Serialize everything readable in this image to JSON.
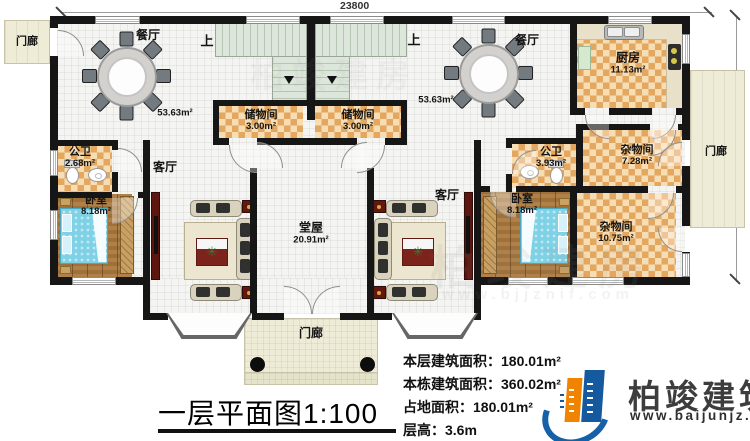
{
  "dimensions": {
    "top": "23800",
    "right": "12300"
  },
  "rooms": {
    "porch_top_left": {
      "label": "门廊"
    },
    "porch_right": {
      "label": "门廊"
    },
    "porch_bottom": {
      "label": "门廊"
    },
    "dining_left": {
      "label": "餐厅",
      "area": "53.63m²"
    },
    "dining_right": {
      "label": "餐厅",
      "area": "53.63m²"
    },
    "stairs_left": {
      "label": "上"
    },
    "stairs_right": {
      "label": "上"
    },
    "storage_left": {
      "label": "储物间",
      "area": "3.00m²"
    },
    "storage_right": {
      "label": "储物间",
      "area": "3.00m²"
    },
    "kitchen": {
      "label": "厨房",
      "area": "11.13m²"
    },
    "bath_left": {
      "label": "公卫",
      "area": "2.68m²"
    },
    "bath_right": {
      "label": "公卫",
      "area": "3.93m²"
    },
    "bedroom_left": {
      "label": "卧室",
      "area": "8.18m²"
    },
    "bedroom_right": {
      "label": "卧室",
      "area": "8.18m²"
    },
    "living_left": {
      "label": "客厅"
    },
    "living_right": {
      "label": "客厅"
    },
    "hall": {
      "label": "堂屋",
      "area": "20.91m²"
    },
    "utility_upper": {
      "label": "杂物间",
      "area": "7.28m²"
    },
    "utility_lower": {
      "label": "杂物间",
      "area": "10.75m²"
    }
  },
  "title": {
    "text": "一层平面图1:100"
  },
  "stats": {
    "lines": [
      {
        "label": "本层建筑面积：",
        "value": "180.01m²"
      },
      {
        "label": "本栋建筑面积：",
        "value": "360.02m²"
      },
      {
        "label": "占地面积：",
        "value": "180.01m²"
      },
      {
        "label": "层高：",
        "value": "3.6m"
      }
    ]
  },
  "logo": {
    "name": "柏竣建筑",
    "site": "www.baijunjz.com"
  },
  "watermark": {
    "text": "柏竣建房",
    "site": "www.bjjznif.com"
  },
  "colors": {
    "wall": "#161616",
    "checker": "#e3a75f",
    "wood": "#a9773b",
    "bed": "#7fd2e6",
    "porch": "#eeebd6",
    "stairs": "#dde6da",
    "accent_red": "#63170f",
    "logo_blue": "#15599f",
    "logo_orange": "#f08300"
  }
}
